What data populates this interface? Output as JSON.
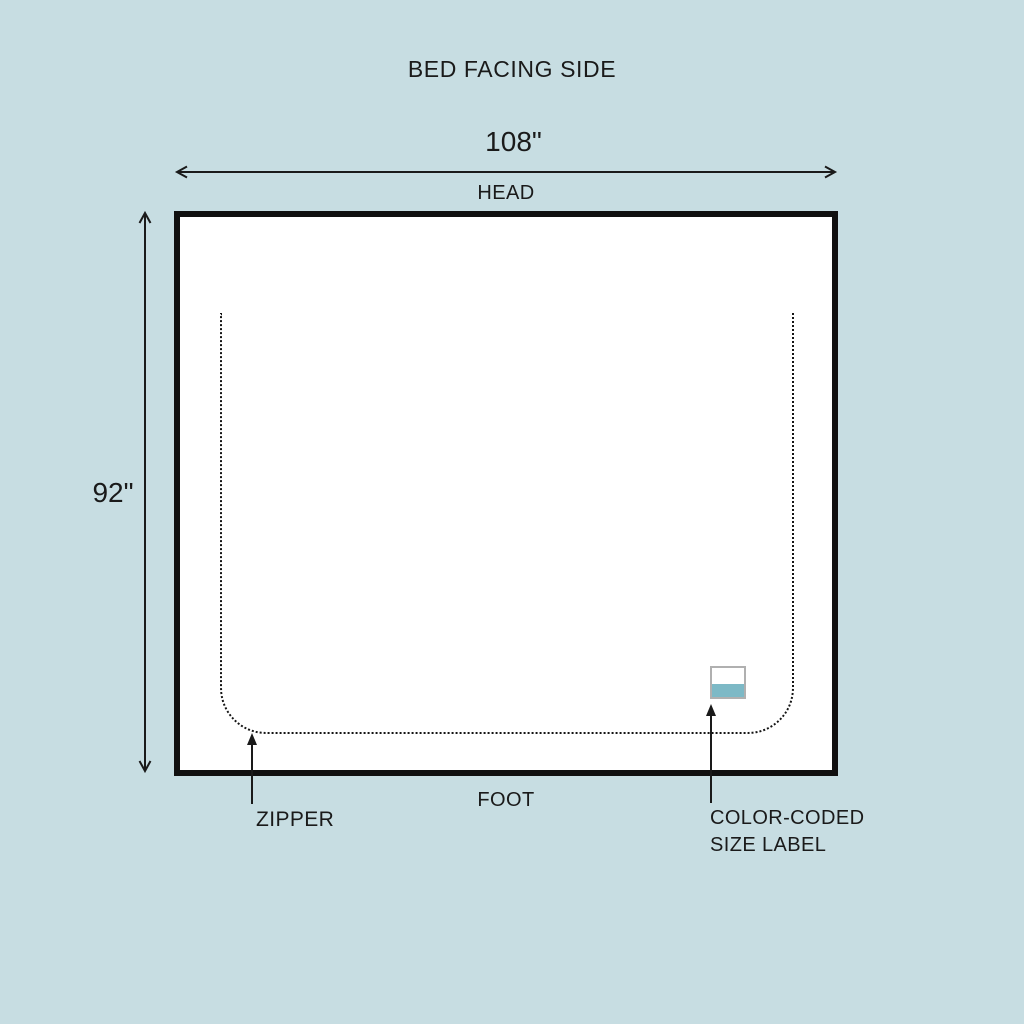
{
  "diagram": {
    "title": "BED FACING SIDE",
    "width_dimension": "108\"",
    "height_dimension": "92\"",
    "head_label": "HEAD",
    "foot_label": "FOOT",
    "zipper_label": "ZIPPER",
    "size_label_caption": {
      "line1": "COLOR-CODED",
      "line2": "SIZE LABEL"
    },
    "colors": {
      "background": "#c7dde2",
      "line": "#1a1a1a",
      "panel_fill": "#ffffff",
      "panel_border": "#101010",
      "stitch_dots": "#151515",
      "size_label_fill": "#ffffff",
      "size_label_border": "#b0b0b0",
      "size_label_stripe": "#7db9c6"
    }
  }
}
